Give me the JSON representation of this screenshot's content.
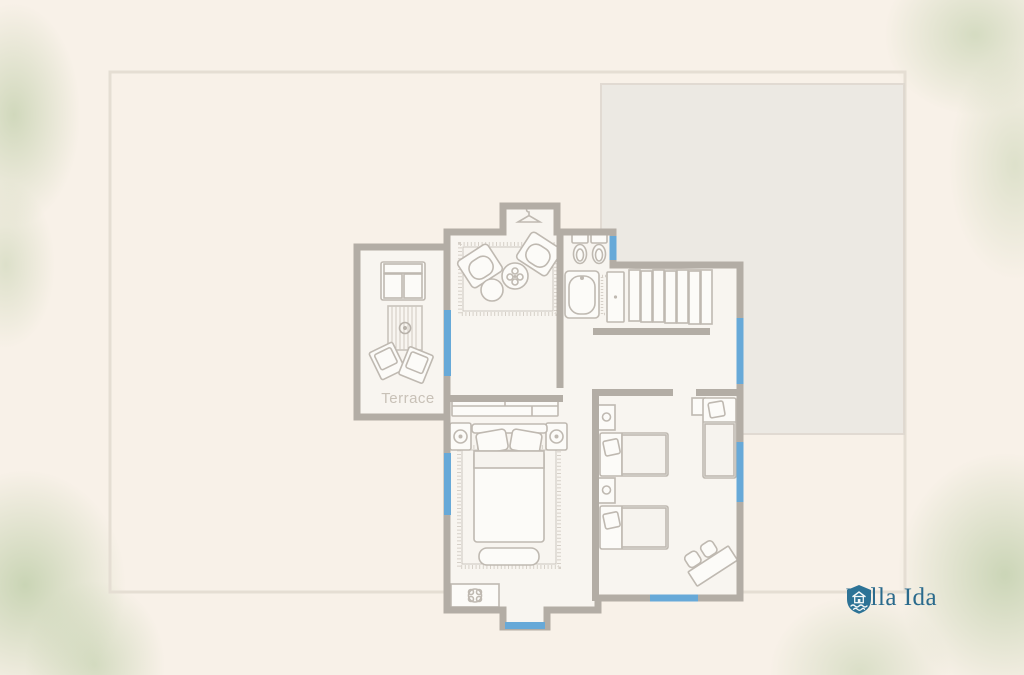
{
  "background": {
    "page_color": "#f8f1e8",
    "foliage_color": "#cfdec4"
  },
  "plan": {
    "terrace_label": "Terrace",
    "colors": {
      "wall": "#b3ada5",
      "furniture_line": "#bfb9b1",
      "window_accent": "#67a9d8",
      "floor_fill": "#f8f5f0",
      "boundary_line": "#e5ded3",
      "neighbor_fill": "#ebe8e3",
      "terrace_label_color": "#c8c1b7"
    },
    "icons": [
      "hanger-icon",
      "sofa-icon",
      "armchair-icon",
      "striped-rug-icon",
      "fringed-rug-icon",
      "round-table-icon",
      "plant-table-icon",
      "toilet-icon",
      "bathtub-icon",
      "bath-mat-icon",
      "wardrobe-icon",
      "cabinet-icon",
      "double-bed-icon",
      "single-bed-icon",
      "nightstand-icon",
      "bench-icon",
      "desk-with-chairs-icon",
      "flower-planter-icon"
    ]
  },
  "brand": {
    "name": "Villa Ida",
    "color": "#2a6a8c",
    "icon": "shield-house-icon"
  }
}
